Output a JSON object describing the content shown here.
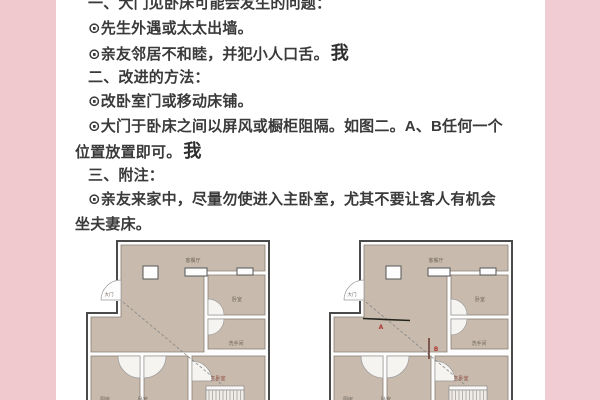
{
  "colors": {
    "side_band": "#f0c9ce",
    "room_fill": "#c8bbae",
    "wall_outline": "#4a4a4a",
    "text": "#3a3a3a",
    "marker_red": "#b03a34",
    "master_label": "#8c4a3e"
  },
  "article": {
    "lines": [
      {
        "text": "一、大门见卧床可能会发生的问题："
      },
      {
        "text": "⊙先生外遇或太太出墙。"
      },
      {
        "text": "⊙亲友邻居不和睦，并犯小人口舌。",
        "suffix": "我"
      },
      {
        "text": "二、改进的方法："
      },
      {
        "text": "⊙改卧室门或移动床铺。"
      },
      {
        "text": "⊙大门于卧床之间以屏风或橱柜阻隔。如图二。A、B任何一个"
      },
      {
        "text": "位置放置即可。",
        "suffix": "我"
      },
      {
        "text": "三、附注："
      },
      {
        "text": "⊙亲友来家中，尽量勿使进入主卧室，尤其不要让客人有机会"
      },
      {
        "text": "坐夫妻床。"
      }
    ]
  },
  "floorplans": {
    "plan1": {
      "entrance_label": "大门",
      "living_label": "客餐厅",
      "bedroom_label": "卧室",
      "bathroom_label": "洗手间",
      "master_label": "主卧室",
      "kitchen_label": "厨房",
      "second_room_label": "卧室"
    },
    "plan2": {
      "entrance_label": "大门",
      "living_label": "客餐厅",
      "bedroom_label": "卧室",
      "bathroom_label": "洗手间",
      "master_label": "主卧室",
      "kitchen_label": "厨房",
      "second_room_label": "卧室",
      "marker_a": "A",
      "marker_b": "B"
    }
  }
}
